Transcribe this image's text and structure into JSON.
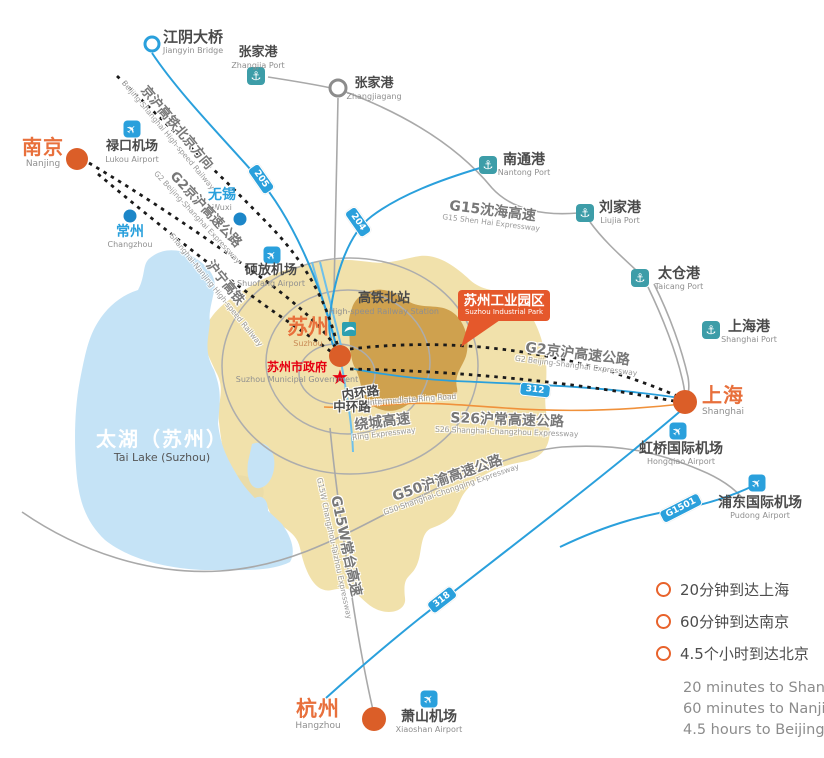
{
  "cities": {
    "nanjing": {
      "zh": "南京",
      "en": "Nanjing"
    },
    "wuxi": {
      "zh": "无锡",
      "en": "Wuxi"
    },
    "changzhou": {
      "zh": "常州",
      "en": "Changzhou"
    },
    "zhangjiagang": {
      "zh": "张家港",
      "en": "Zhangjiagang"
    },
    "suzhou": {
      "zh": "苏州",
      "en": "Suzhou"
    },
    "shanghai": {
      "zh": "上海",
      "en": "Shanghai"
    },
    "hangzhou": {
      "zh": "杭州",
      "en": "Hangzhou"
    }
  },
  "ports": {
    "zhangjia": {
      "zh": "张家港",
      "en": "Zhangjia Port"
    },
    "nantong": {
      "zh": "南通港",
      "en": "Nantong Port"
    },
    "liujia": {
      "zh": "刘家港",
      "en": "Liujia Port"
    },
    "taicang": {
      "zh": "太仓港",
      "en": "Taicang Port"
    },
    "shanghaigang": {
      "zh": "上海港",
      "en": "Shanghai Port"
    }
  },
  "airports": {
    "lukou": {
      "zh": "禄口机场",
      "en": "Lukou Airport"
    },
    "shuofang": {
      "zh": "硕放机场",
      "en": "Shuofang Airport"
    },
    "hongqiao": {
      "zh": "虹桥国际机场",
      "en": "Hongqiao Airport"
    },
    "pudong": {
      "zh": "浦东国际机场",
      "en": "Pudong Airport"
    },
    "xiaoshan": {
      "zh": "萧山机场",
      "en": "Xiaoshan Airport"
    }
  },
  "landmarks": {
    "jiangyin_bridge": {
      "zh": "江阴大桥",
      "en": "Jiangyin Bridge"
    },
    "railway_station": {
      "zh": "高铁北站",
      "en": "High-speed Railway Station"
    },
    "government": {
      "zh": "苏州市政府",
      "en": "Suzhou Municipal Government"
    },
    "tai_lake": {
      "zh": "太湖（苏州）",
      "en": "Tai Lake (Suzhou)"
    },
    "industrial_park": {
      "zh": "苏州工业园区",
      "en": "Suzhou Industrial Park"
    }
  },
  "roads": {
    "hsr_beijing": {
      "zh": "京沪高铁北京方向",
      "en": "Beijing-Shanghai High-speed Railway"
    },
    "g2_west": {
      "zh": "G2京沪高速公路",
      "en": "G2 Beijing-Shanghai Expressway"
    },
    "huning_hsr": {
      "zh": "沪宁高铁",
      "en": "Shanghai-Nanjing High-speed Railway"
    },
    "g15": {
      "zh": "G15沈海高速",
      "en": "G15 Shen Hai Expressway"
    },
    "g2_east": {
      "zh": "G2京沪高速公路",
      "en": "G2 Beijing-Shanghai Expressway"
    },
    "s26": {
      "zh": "S26沪常高速公路",
      "en": "S26 Shanghai-Changzhou Expressway"
    },
    "g50": {
      "zh": "G50沪渝高速公路",
      "en": "G50 Shanghai-Chongqing Expressway"
    },
    "g15w": {
      "zh": "G15W常台高速",
      "en": "G15W Changzhou-Taizhou Expressway"
    },
    "inner_loop": {
      "zh": "内环路",
      "en": "Inner Loop"
    },
    "middle_ring": {
      "zh": "中环路",
      "en": "Intermediate Ring Road"
    },
    "ring_expressway": {
      "zh": "绕城高速",
      "en": "Ring Expressway"
    }
  },
  "route_shields": {
    "r205": "205",
    "r204": "204",
    "r312": "312",
    "r318": "318",
    "g1501": "G1501"
  },
  "legend": {
    "zh": [
      "20分钟到达上海",
      "60分钟到达南京",
      "4.5个小时到达北京"
    ],
    "en": [
      "20 minutes to Shanghai",
      "60 minutes  to Nanjing",
      "4.5 hours  to Beijing"
    ]
  },
  "colors": {
    "city_orange": "#DB5E28",
    "route_blue": "#2AA0DC",
    "port_teal": "#3D9DA8",
    "land_tan": "#F1E1AB",
    "park_brown": "#CFA14E",
    "lake_blue": "#C5E3F6",
    "callout_orange": "#E5582B",
    "star_red": "#E60012",
    "s26_orange": "#F0913B"
  }
}
